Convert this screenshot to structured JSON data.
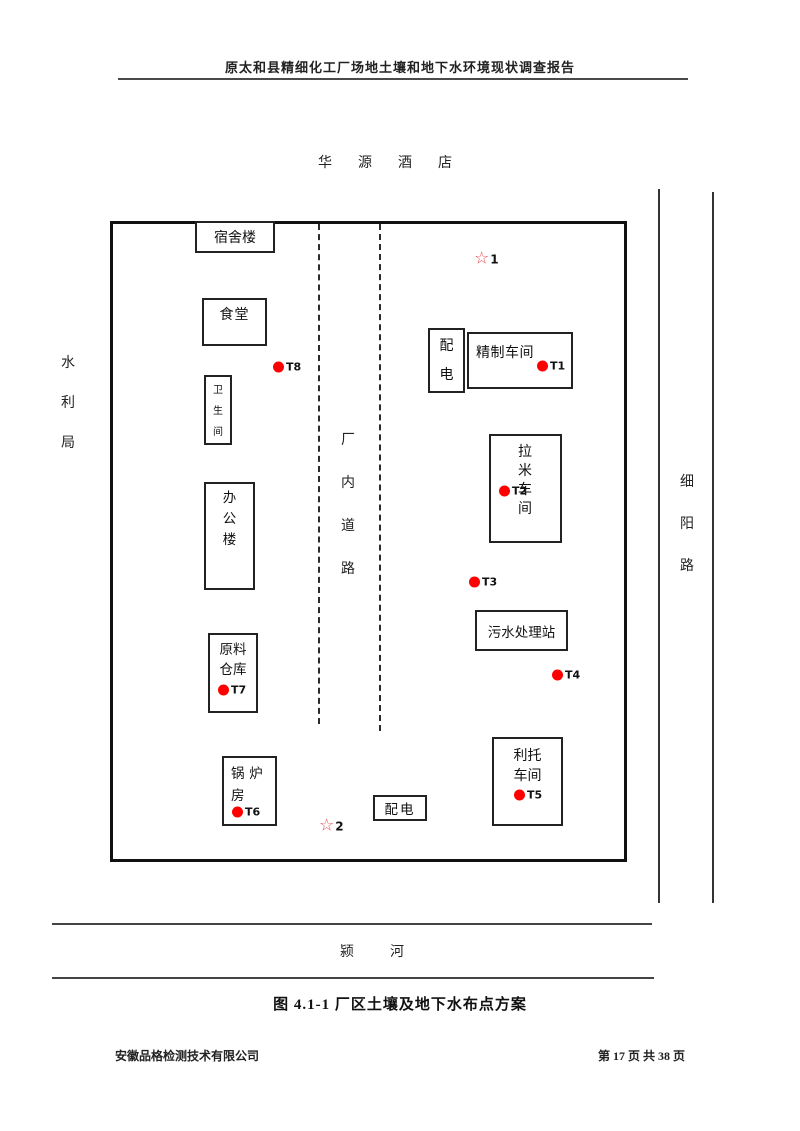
{
  "document": {
    "header_title": "原太和县精细化工厂场地土壤和地下水环境现状调查报告",
    "figure_caption": "图 4.1-1 厂区土壤及地下水布点方案",
    "footer": {
      "company": "安徽品格检测技术有限公司",
      "page_info": "第 17 页 共 38 页"
    }
  },
  "surroundings": {
    "north_label": "华源酒店",
    "west_label": "水利局",
    "east_label": "细阳路",
    "south_label": "颍河"
  },
  "site_map": {
    "internal_road_label": "厂内道路",
    "buildings": [
      {
        "id": "dormitory",
        "label": "宿舍楼"
      },
      {
        "id": "canteen",
        "label": "食堂"
      },
      {
        "id": "restroom",
        "label": "卫生间"
      },
      {
        "id": "office-building",
        "label": "办公楼"
      },
      {
        "id": "raw-material-warehouse",
        "label": "原料仓库"
      },
      {
        "id": "boiler-room",
        "label": "锅炉房"
      },
      {
        "id": "power-distribution-top",
        "label": "配电"
      },
      {
        "id": "refining-workshop",
        "label": "精制车间"
      },
      {
        "id": "lami-workshop",
        "label": "拉米车间"
      },
      {
        "id": "sewage-treatment-station",
        "label": "污水处理站"
      },
      {
        "id": "lituo-workshop",
        "label": "利托车间"
      },
      {
        "id": "power-distribution-bottom",
        "label": "配电"
      }
    ],
    "soil_sample_points": [
      {
        "label": "T1"
      },
      {
        "label": "T2"
      },
      {
        "label": "T3"
      },
      {
        "label": "T4"
      },
      {
        "label": "T5"
      },
      {
        "label": "T6"
      },
      {
        "label": "T7"
      },
      {
        "label": "T8"
      }
    ],
    "star_points": [
      {
        "label": "1",
        "symbol": "☆"
      },
      {
        "label": "2",
        "symbol": "☆"
      }
    ],
    "colors": {
      "sample_dot": "#fe0000",
      "star": "#e84b50"
    }
  }
}
